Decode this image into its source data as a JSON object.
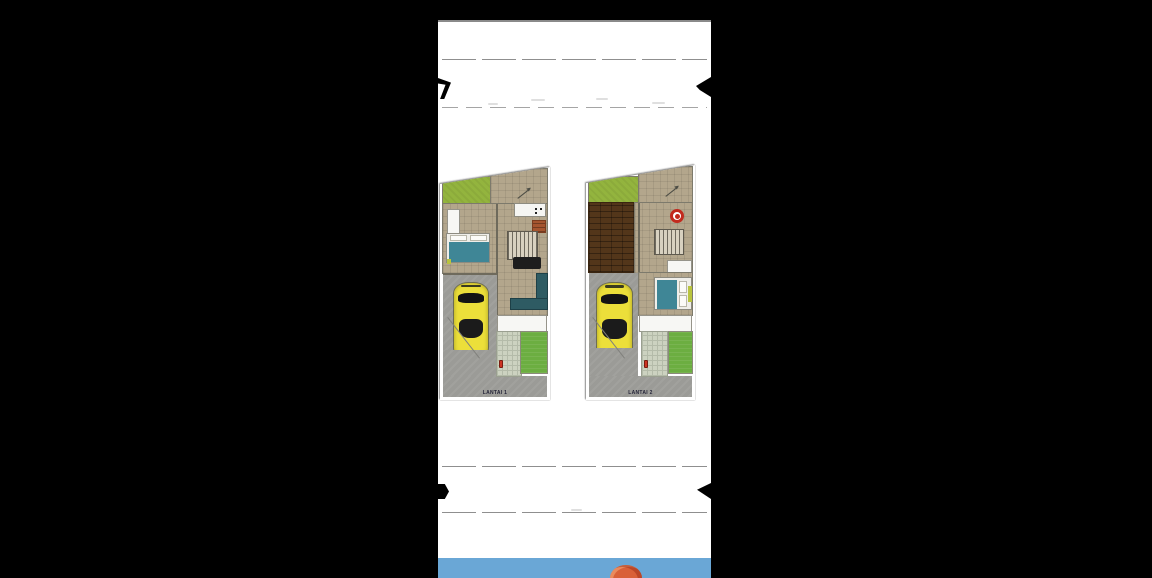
{
  "window": {
    "background": "#000000"
  },
  "page": {
    "background": "#ffffff",
    "top_edge_color": "#8a8a8a"
  },
  "top_banner": {
    "ribbon_color": "#000000",
    "rule_color": "#8f8f8f",
    "visible_text": ""
  },
  "bottom_banner": {
    "ribbon_color": "#000000",
    "rule_color": "#8f8f8f",
    "visible_text": ""
  },
  "floor_plans": [
    {
      "label": "LANTAI 1"
    },
    {
      "label": "LANTAI 2"
    }
  ],
  "palette": {
    "floor_tan": "#b3a68c",
    "garden_green": "#93b43e",
    "lawn_green": "#6cae41",
    "wood_floor_brown": "#53361a",
    "bed_teal": "#3f8696",
    "sofa_teal": "#2e5b63",
    "car_yellow": "#ecdf3a",
    "driveway_gray": "#9b9b97",
    "paver_gray_green": "#ccd2c0",
    "brick_orange": "#a5552f",
    "hydrant_red": "#cc3322",
    "round_table_red": "#c22a1e"
  },
  "footer_scene": {
    "sky_color": "#6aa7d6",
    "balloon_top_color": "#d96038"
  }
}
